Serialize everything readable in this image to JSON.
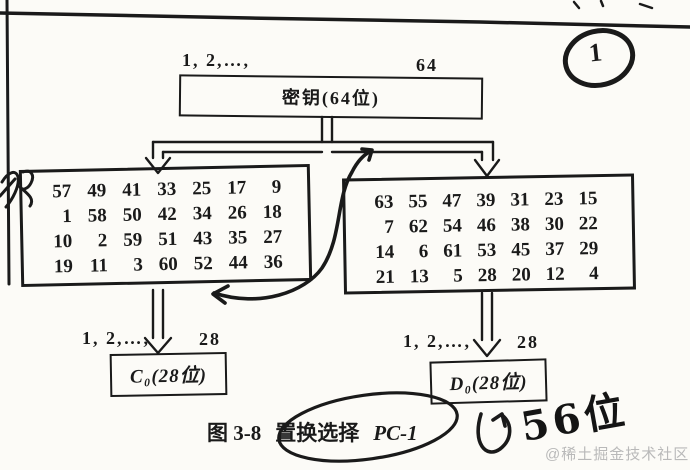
{
  "page": {
    "background": "#fcfbf7",
    "ink_color": "#1a1a1a",
    "watermark_color": "#b9b9b9"
  },
  "key_stage": {
    "index_start": "1, 2,…,",
    "index_end": "64",
    "label": "密钥(64位)"
  },
  "pc1_tables": {
    "left": {
      "rows": [
        [
          "57",
          "49",
          "41",
          "33",
          "25",
          "17",
          "9"
        ],
        [
          "1",
          "58",
          "50",
          "42",
          "34",
          "26",
          "18"
        ],
        [
          "10",
          "2",
          "59",
          "51",
          "43",
          "35",
          "27"
        ],
        [
          "19",
          "11",
          "3",
          "60",
          "52",
          "44",
          "36"
        ]
      ]
    },
    "right": {
      "rows": [
        [
          "63",
          "55",
          "47",
          "39",
          "31",
          "23",
          "15"
        ],
        [
          "7",
          "62",
          "54",
          "46",
          "38",
          "30",
          "22"
        ],
        [
          "14",
          "6",
          "61",
          "53",
          "45",
          "37",
          "29"
        ],
        [
          "21",
          "13",
          "5",
          "28",
          "20",
          "12",
          "4"
        ]
      ]
    }
  },
  "c_register": {
    "index_start": "1, 2,…,",
    "index_end": "28",
    "label": "C₀(28位)"
  },
  "d_register": {
    "index_start": "1, 2,…,",
    "index_end": "28",
    "label": "D₀(28位)"
  },
  "caption": {
    "figure": "图 3-8",
    "title_cn": "置换选择",
    "title_en": "PC-1"
  },
  "annotations": {
    "circled_number": "1",
    "margin_note": "56位"
  },
  "watermark": "@稀土掘金技术社区"
}
